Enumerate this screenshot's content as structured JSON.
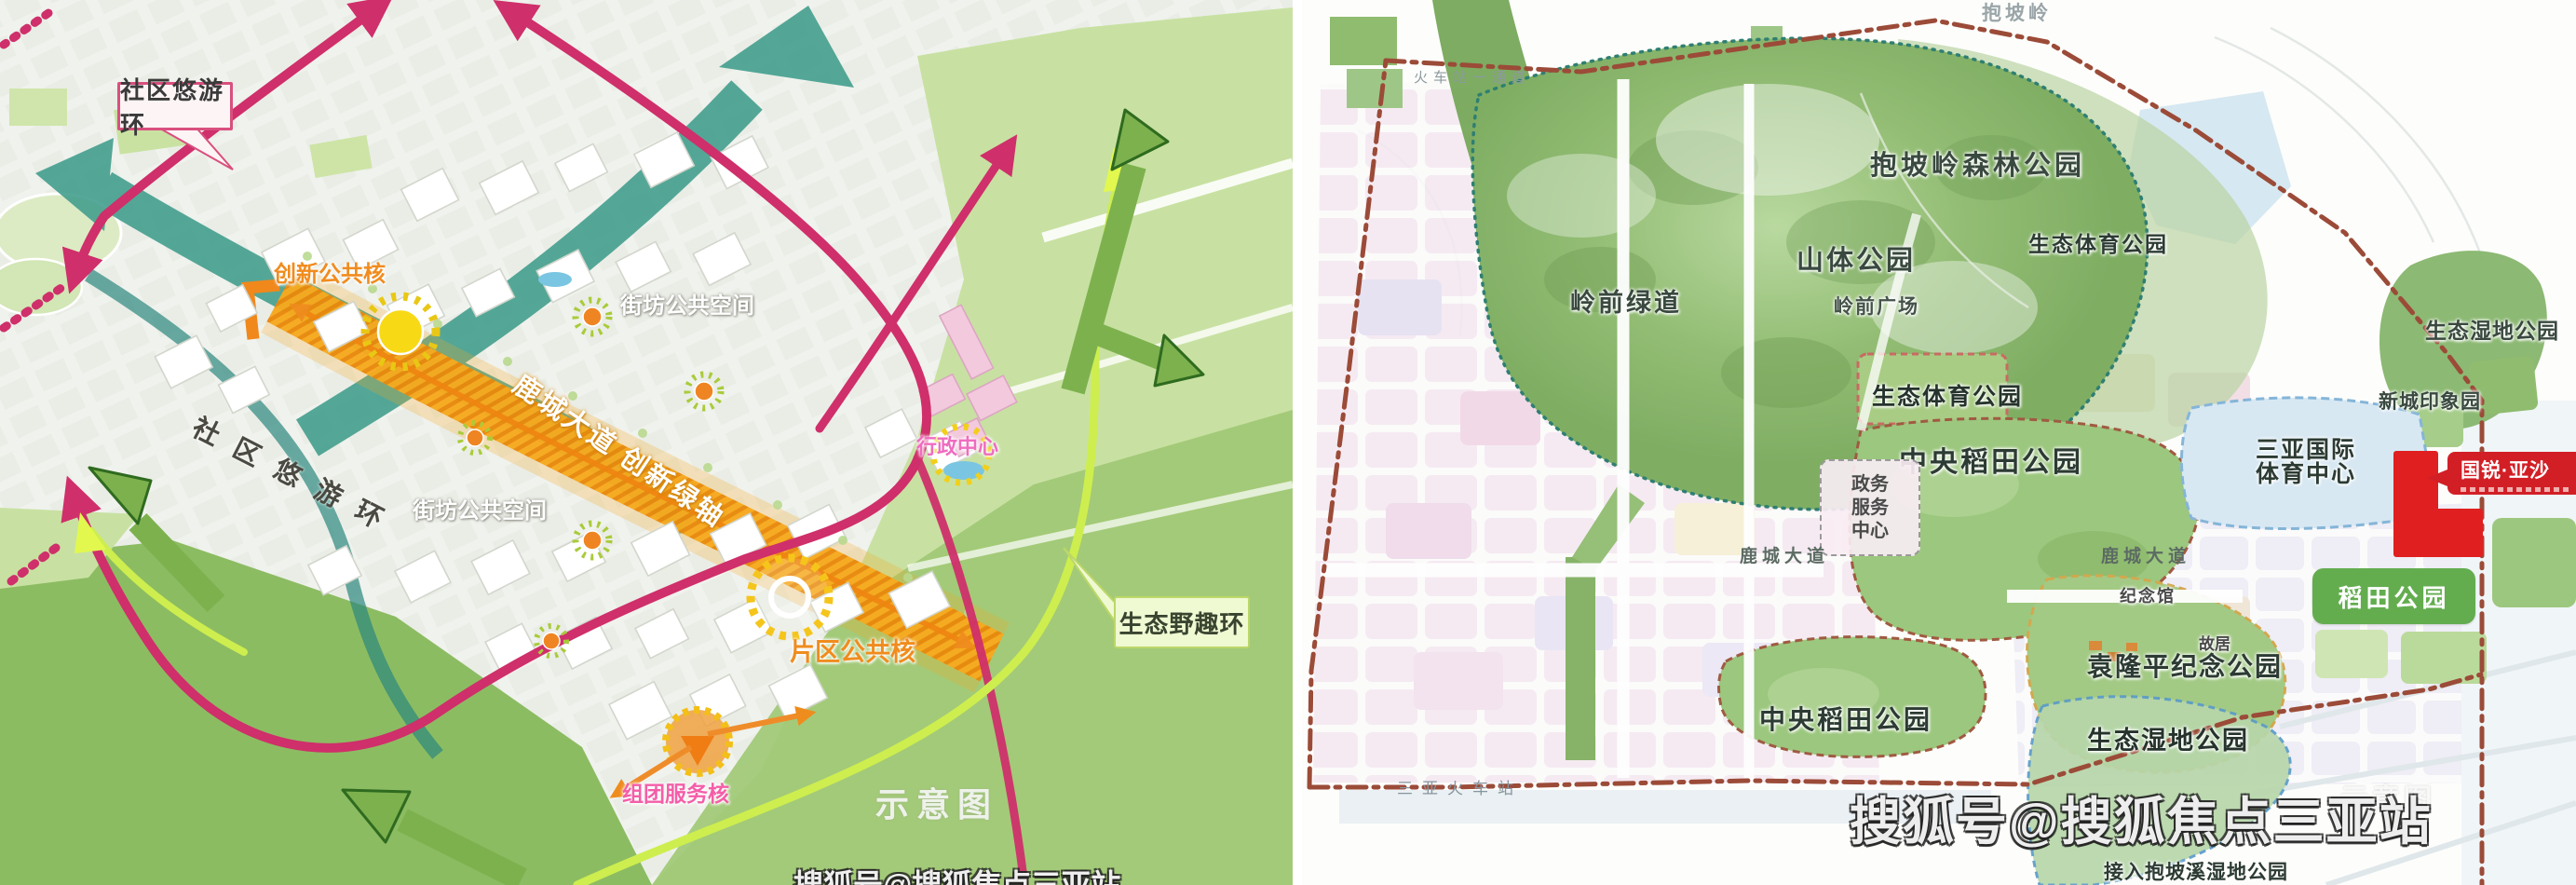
{
  "title": "三亚抱坡片区规划示意图（两幅）",
  "colors": {
    "magenta_ring": "#cf2f6a",
    "teal_corridor": "#3f9d8c",
    "orange_axis": "#f6a91e",
    "chartreuse_ring": "#cdee4e",
    "boundary_brown": "#9b4b38",
    "brand_red": "#d21f26",
    "park_green": "#9cc77e",
    "forest_green": "#7fae63"
  },
  "left": {
    "callout": "社区悠游环",
    "ring_label": "社区悠游环",
    "innovation_core": "创新公共核",
    "block_space_a": "街坊公共空间",
    "block_space_b": "街坊公共空间",
    "axis": "鹿城大道 创新绿轴",
    "admin_center": "行政中心",
    "eco_ring": "生态野趣环",
    "district_core": "片区公共核",
    "cluster_core": "组团服务核",
    "sketch": "示意图",
    "sohu_partial": "搜狐号@搜狐焦点三亚站"
  },
  "right": {
    "station_corridor": "火车站一通道",
    "baopoling": "抱坡岭",
    "forest_park": "抱坡岭森林公园",
    "mountain_park": "山体公园",
    "lingqian_plaza": "岭前广场",
    "lingqian_greenway": "岭前绿道",
    "eco_sports_a": "生态体育公园",
    "eco_sports_b": "生态体育公园",
    "eco_wetland_a": "生态湿地公园",
    "new_city_garden": "新城印象园",
    "intl_sports_line1": "三亚国际",
    "intl_sports_line2": "体育中心",
    "central_rice_a": "中央稻田公园",
    "gov_line1": "政务",
    "gov_line2": "服务",
    "gov_line3": "中心",
    "lucheng_ave_a": "鹿城大道",
    "lucheng_ave_b": "鹿城大道",
    "memorial_hall": "纪念馆",
    "former_residence": "故居",
    "rice_park": "稻田公园",
    "yuan_memorial_park": "袁隆平纪念公园",
    "central_rice_b": "中央稻田公园",
    "eco_wetland_b": "生态湿地公园",
    "wetland_connect": "接入抱坡溪湿地公园",
    "sanya_station": "三亚火车站",
    "brand": "国锐·亚沙",
    "sketch": "示意图",
    "sohu": "搜狐号@搜狐焦点三亚站"
  }
}
